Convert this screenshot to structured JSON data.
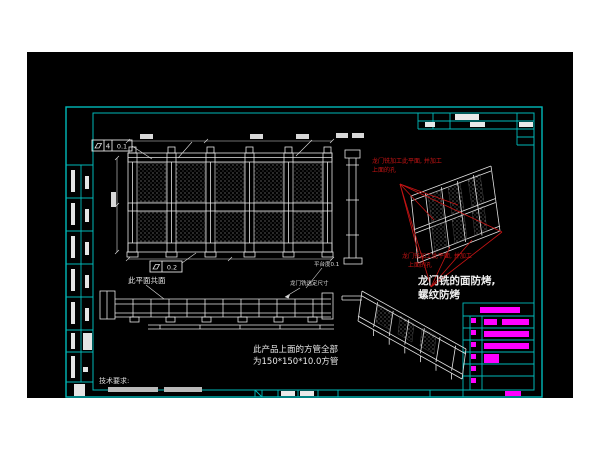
{
  "drawing": {
    "type": "CAD engineering drawing",
    "colors": {
      "canvas": "#000000",
      "frame_cyan": "#00b9b9",
      "line_white": "#e4e4e4",
      "annotation_red": "#c81414",
      "title_magenta": "#ff00ff",
      "page_white": "#ffffff"
    },
    "notes": {
      "red_top_line1": "龙门铣加工此平面, 并加工",
      "red_top_line2": "上面的孔",
      "red_bottom_line1": "龙门铣加工此平面, 并加工",
      "red_bottom_line2": "上面的孔",
      "main_line1": "龙门铣的面防烤,",
      "main_line2": "螺纹防烤",
      "tube_line1": "此产品上面的方管全部",
      "tube_line2": "为150*150*10.0方管",
      "coplanar": "此平面共面",
      "platform_flatness": "平台度0.1",
      "gantry_dim": "龙门铣选定尺寸",
      "tech_req_title": "技术要求:"
    },
    "feature_control_frames": {
      "fcf1_cell2": "4",
      "fcf1_cell3": "0.1",
      "fcf2_value": "0.2"
    }
  }
}
